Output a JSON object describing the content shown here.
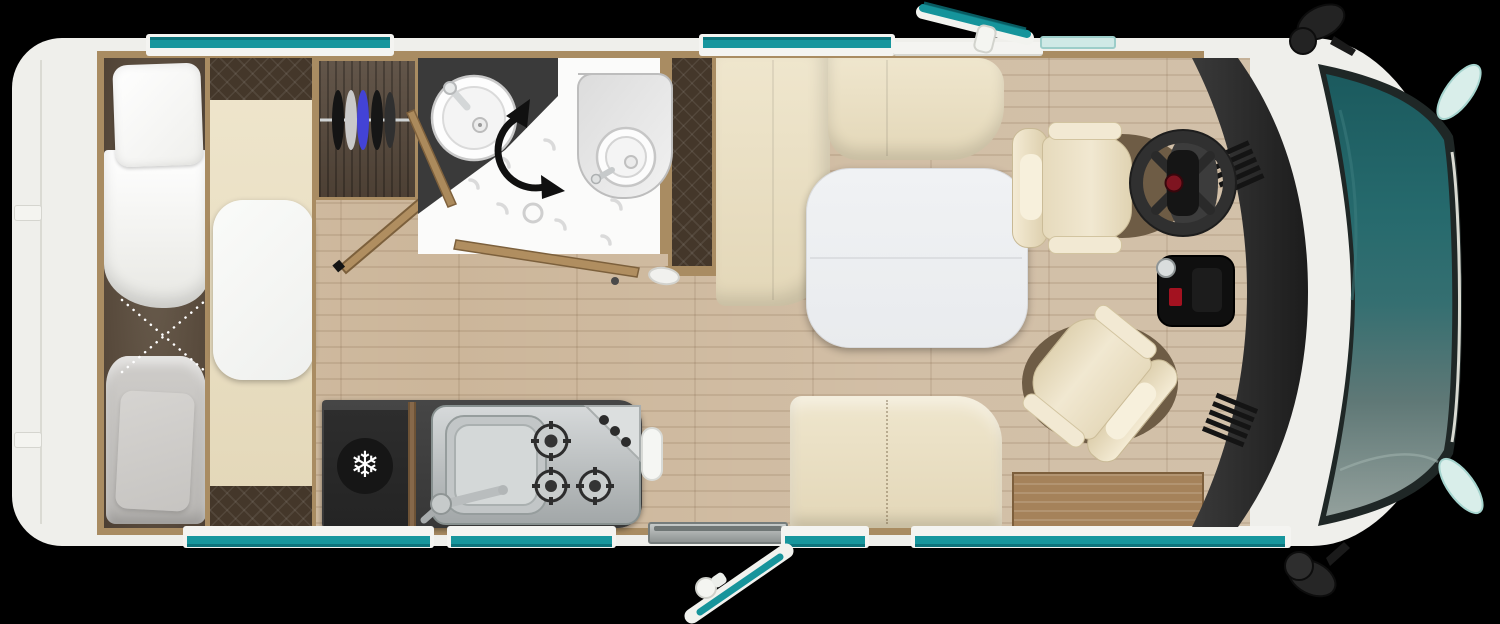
{
  "scene": {
    "type": "motorhome-floorplan-top-view",
    "front_direction": "right"
  },
  "icons": {
    "fridge_snowflake": "❄"
  },
  "palette": {
    "background": "#000000",
    "body_white": "#efefeb",
    "accent_teal": "#17969d",
    "glass_light_teal": "#cfe9e6",
    "windshield_teal": "#1d5f63",
    "wood_trim": "#a98c62",
    "floor_wood": "#ccb69a",
    "counter_dark": "#3d3d3d",
    "upholstery_cream": "#e9dfc5",
    "quilt_brown": "#44372a",
    "mattress_brown": "#5e5143",
    "duvet_white": "#fbfbfa",
    "duvet_grey": "#c7c5c2",
    "table_white": "#eef0f2",
    "dashboard_black": "#2a2a2a",
    "steel": "#c0c4c5",
    "step_wood": "#a5825a",
    "toilet_grey": "#d9d9d9",
    "steering_badge_red": "#7e1420"
  },
  "counts": {
    "hob_burners": 3,
    "knob_dots": 3,
    "wardrobe_hangers": 5,
    "cab_seats": 2,
    "dinette_benches": 3,
    "beds": 1,
    "teal_windows_top": 2,
    "teal_windows_bottom": 4,
    "open_doors": 3,
    "open_roof_window": 1,
    "mirrors": 2
  },
  "legend": [
    "rear transverse bed with pillow and two duvets",
    "bedside bench with white nightstand",
    "wardrobe with hanger rail",
    "bathroom with washbasin, toilet and swivel shower wall",
    "kitchen with fridge, sink and 3-burner gas hob",
    "dinette with L-sofa, side bench and white table",
    "entrance door shown open",
    "two cab seats, one swivelled to the lounge",
    "dashboard with steering wheel",
    "cab with teal windshield and twin mirrors"
  ]
}
